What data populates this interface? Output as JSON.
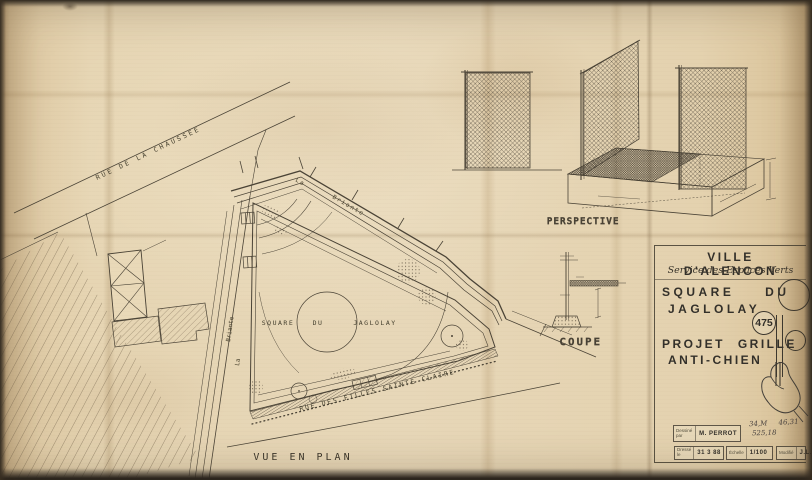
{
  "plan": {
    "street_top": "RUE DE LA CHAUSSÉE",
    "river_word_la": "La",
    "river_word_briante": "Briante",
    "river_left_la": "La",
    "river_left_briante": "Briante",
    "square_word1": "SQUARE",
    "square_word2": "DU",
    "square_word3": "JAGLOLAY",
    "street_bottom": "RUE DES FILLES SAINTE CLAIRE",
    "caption": "VUE EN PLAN"
  },
  "perspective": {
    "caption": "PERSPECTIVE"
  },
  "section": {
    "caption": "COUPE"
  },
  "title_block": {
    "city": "VILLE D'ALENCON",
    "service": "Service des Espaces Verts",
    "title_line1": "SQUARE DU",
    "title_line2": "JAGLOLAY",
    "plan_number": "475",
    "subtitle_line1": "PROJET GRILLE",
    "subtitle_line2": "ANTI-CHIEN",
    "drawn_label": "Dessiné par",
    "drawn_value": "M. PERROT",
    "date_label": "Dressé le",
    "date_value": "31 3 88",
    "scale_label": "Échelle",
    "scale_value": "1/100",
    "revision_label": "Modifié",
    "revision_value": "J.L.J",
    "note_line1": "34,M 46,31",
    "note_line2": "525,18"
  },
  "colors": {
    "ink": "#443f36",
    "paper": "#e5d3b1",
    "paper_edge": "#2e2a25"
  }
}
